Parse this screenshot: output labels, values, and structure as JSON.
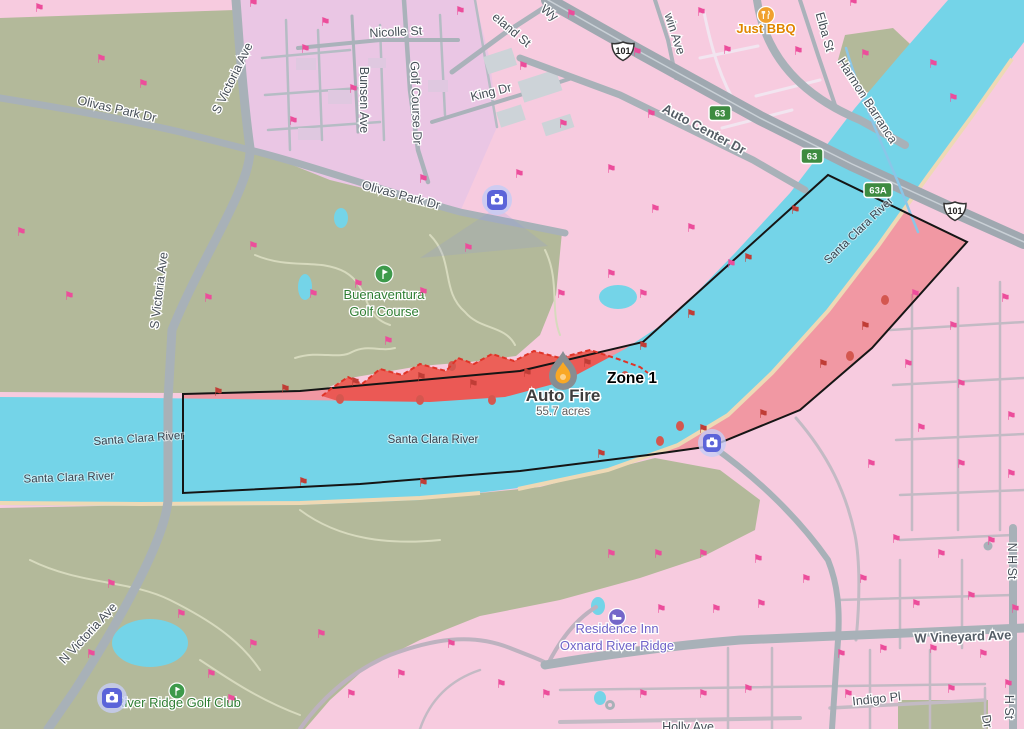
{
  "map": {
    "fire": {
      "zone": "Zone 1",
      "name": "Auto Fire",
      "acres": "55.7 acres"
    },
    "labels": {
      "wy": "Wy",
      "eland_st": "eland St",
      "nicolle_st": "Nicolle St",
      "win_ave": "win Ave",
      "king_dr": "King Dr",
      "bunsen_ave": "Bunsen Ave",
      "golf_course_dr": "Golf Course Dr",
      "just_bbq": "Just BBQ",
      "elba_st": "Elba St",
      "harmon_barranca": "Harmon Barranca",
      "auto_center_dr": "Auto Center Dr",
      "olivas_park_dr": "Olivas Park Dr",
      "s_victoria_ave": "S Victoria Ave",
      "n_victoria_ave": "N Victoria Ave",
      "buenaventura_line1": "Buenaventura",
      "buenaventura_line2": "Golf Course",
      "santa_clara_river": "Santa Clara River",
      "river_ridge_golf_club": "River Ridge Golf Club",
      "residence_inn_line1": "Residence Inn",
      "residence_inn_line2": "Oxnard River Ridge",
      "w_vineyard_ave": "W Vineyard Ave",
      "indigo_pl": "Indigo Pl",
      "holly_ave": "Holly Ave",
      "n_h_st": "N H St",
      "h_st": "H St",
      "dr": "Dr"
    },
    "shields": {
      "us101": "101",
      "sr63": "63",
      "sr63a": "63A"
    },
    "colors": {
      "base_pink": "#f7cbdf",
      "lavender": "#eac6e4",
      "olive": "#b3b99a",
      "river_cyan": "#74d4e8",
      "zone_fill": "rgba(233,80,80,0.42)",
      "fire_scar": "#ec6058",
      "scar_dash": "#e03428",
      "zone_outline": "#151515",
      "flag_pink": "#ec4d9b",
      "flag_red": "#c03d36",
      "shield_green": "#3d8b40",
      "camera_blue": "#5b64d9",
      "shore_tan": "#eed9b5"
    },
    "markers": {
      "flag_glyph": "⚑",
      "flags": [
        {
          "x": 36,
          "y": 12,
          "c": "p"
        },
        {
          "x": 250,
          "y": 7,
          "c": "p"
        },
        {
          "x": 322,
          "y": 26,
          "c": "p"
        },
        {
          "x": 457,
          "y": 15,
          "c": "p"
        },
        {
          "x": 520,
          "y": 70,
          "c": "p"
        },
        {
          "x": 568,
          "y": 18,
          "c": "p"
        },
        {
          "x": 634,
          "y": 56,
          "c": "p"
        },
        {
          "x": 698,
          "y": 16,
          "c": "p"
        },
        {
          "x": 724,
          "y": 54,
          "c": "p"
        },
        {
          "x": 795,
          "y": 55,
          "c": "p"
        },
        {
          "x": 850,
          "y": 6,
          "c": "p"
        },
        {
          "x": 862,
          "y": 58,
          "c": "p"
        },
        {
          "x": 930,
          "y": 68,
          "c": "p"
        },
        {
          "x": 950,
          "y": 102,
          "c": "p"
        },
        {
          "x": 302,
          "y": 53,
          "c": "p"
        },
        {
          "x": 350,
          "y": 93,
          "c": "p"
        },
        {
          "x": 290,
          "y": 125,
          "c": "p"
        },
        {
          "x": 420,
          "y": 183,
          "c": "p"
        },
        {
          "x": 516,
          "y": 178,
          "c": "p"
        },
        {
          "x": 560,
          "y": 128,
          "c": "p"
        },
        {
          "x": 608,
          "y": 173,
          "c": "p"
        },
        {
          "x": 648,
          "y": 118,
          "c": "p"
        },
        {
          "x": 652,
          "y": 213,
          "c": "p"
        },
        {
          "x": 688,
          "y": 232,
          "c": "p"
        },
        {
          "x": 728,
          "y": 268,
          "c": "p"
        },
        {
          "x": 608,
          "y": 278,
          "c": "p"
        },
        {
          "x": 558,
          "y": 298,
          "c": "p"
        },
        {
          "x": 640,
          "y": 298,
          "c": "p"
        },
        {
          "x": 98,
          "y": 63,
          "c": "p"
        },
        {
          "x": 140,
          "y": 88,
          "c": "p"
        },
        {
          "x": 18,
          "y": 236,
          "c": "p"
        },
        {
          "x": 66,
          "y": 300,
          "c": "p"
        },
        {
          "x": 205,
          "y": 302,
          "c": "p"
        },
        {
          "x": 250,
          "y": 250,
          "c": "p"
        },
        {
          "x": 310,
          "y": 298,
          "c": "p"
        },
        {
          "x": 355,
          "y": 288,
          "c": "p"
        },
        {
          "x": 420,
          "y": 296,
          "c": "p"
        },
        {
          "x": 465,
          "y": 252,
          "c": "p"
        },
        {
          "x": 385,
          "y": 345,
          "c": "p"
        },
        {
          "x": 912,
          "y": 298,
          "c": "p"
        },
        {
          "x": 950,
          "y": 330,
          "c": "p"
        },
        {
          "x": 1002,
          "y": 302,
          "c": "p"
        },
        {
          "x": 905,
          "y": 368,
          "c": "p"
        },
        {
          "x": 958,
          "y": 388,
          "c": "p"
        },
        {
          "x": 1008,
          "y": 420,
          "c": "p"
        },
        {
          "x": 918,
          "y": 432,
          "c": "p"
        },
        {
          "x": 868,
          "y": 468,
          "c": "p"
        },
        {
          "x": 958,
          "y": 468,
          "c": "p"
        },
        {
          "x": 1008,
          "y": 478,
          "c": "p"
        },
        {
          "x": 893,
          "y": 543,
          "c": "p"
        },
        {
          "x": 938,
          "y": 558,
          "c": "p"
        },
        {
          "x": 988,
          "y": 545,
          "c": "p"
        },
        {
          "x": 860,
          "y": 583,
          "c": "p"
        },
        {
          "x": 913,
          "y": 608,
          "c": "p"
        },
        {
          "x": 968,
          "y": 600,
          "c": "p"
        },
        {
          "x": 1012,
          "y": 613,
          "c": "p"
        },
        {
          "x": 838,
          "y": 658,
          "c": "p"
        },
        {
          "x": 880,
          "y": 653,
          "c": "p"
        },
        {
          "x": 930,
          "y": 653,
          "c": "p"
        },
        {
          "x": 980,
          "y": 658,
          "c": "p"
        },
        {
          "x": 700,
          "y": 698,
          "c": "p"
        },
        {
          "x": 745,
          "y": 693,
          "c": "p"
        },
        {
          "x": 640,
          "y": 698,
          "c": "p"
        },
        {
          "x": 845,
          "y": 698,
          "c": "p"
        },
        {
          "x": 948,
          "y": 693,
          "c": "p"
        },
        {
          "x": 1005,
          "y": 688,
          "c": "p"
        },
        {
          "x": 713,
          "y": 613,
          "c": "p"
        },
        {
          "x": 758,
          "y": 608,
          "c": "p"
        },
        {
          "x": 658,
          "y": 613,
          "c": "p"
        },
        {
          "x": 608,
          "y": 558,
          "c": "p"
        },
        {
          "x": 655,
          "y": 558,
          "c": "p"
        },
        {
          "x": 700,
          "y": 558,
          "c": "p"
        },
        {
          "x": 755,
          "y": 563,
          "c": "p"
        },
        {
          "x": 803,
          "y": 583,
          "c": "p"
        },
        {
          "x": 108,
          "y": 588,
          "c": "p"
        },
        {
          "x": 178,
          "y": 618,
          "c": "p"
        },
        {
          "x": 88,
          "y": 658,
          "c": "p"
        },
        {
          "x": 208,
          "y": 678,
          "c": "p"
        },
        {
          "x": 250,
          "y": 648,
          "c": "p"
        },
        {
          "x": 318,
          "y": 638,
          "c": "p"
        },
        {
          "x": 228,
          "y": 703,
          "c": "p"
        },
        {
          "x": 348,
          "y": 698,
          "c": "p"
        },
        {
          "x": 398,
          "y": 678,
          "c": "p"
        },
        {
          "x": 448,
          "y": 648,
          "c": "p"
        },
        {
          "x": 498,
          "y": 688,
          "c": "p"
        },
        {
          "x": 543,
          "y": 698,
          "c": "p"
        },
        {
          "x": 215,
          "y": 396,
          "c": "r"
        },
        {
          "x": 282,
          "y": 393,
          "c": "r"
        },
        {
          "x": 352,
          "y": 386,
          "c": "r"
        },
        {
          "x": 418,
          "y": 381,
          "c": "r"
        },
        {
          "x": 470,
          "y": 388,
          "c": "r"
        },
        {
          "x": 524,
          "y": 377,
          "c": "r"
        },
        {
          "x": 584,
          "y": 367,
          "c": "r"
        },
        {
          "x": 640,
          "y": 350,
          "c": "r"
        },
        {
          "x": 688,
          "y": 318,
          "c": "r"
        },
        {
          "x": 745,
          "y": 262,
          "c": "r"
        },
        {
          "x": 792,
          "y": 214,
          "c": "r"
        },
        {
          "x": 862,
          "y": 330,
          "c": "r"
        },
        {
          "x": 820,
          "y": 368,
          "c": "r"
        },
        {
          "x": 760,
          "y": 418,
          "c": "r"
        },
        {
          "x": 700,
          "y": 433,
          "c": "r"
        },
        {
          "x": 598,
          "y": 458,
          "c": "r"
        },
        {
          "x": 420,
          "y": 487,
          "c": "r"
        },
        {
          "x": 300,
          "y": 486,
          "c": "r"
        }
      ]
    }
  }
}
